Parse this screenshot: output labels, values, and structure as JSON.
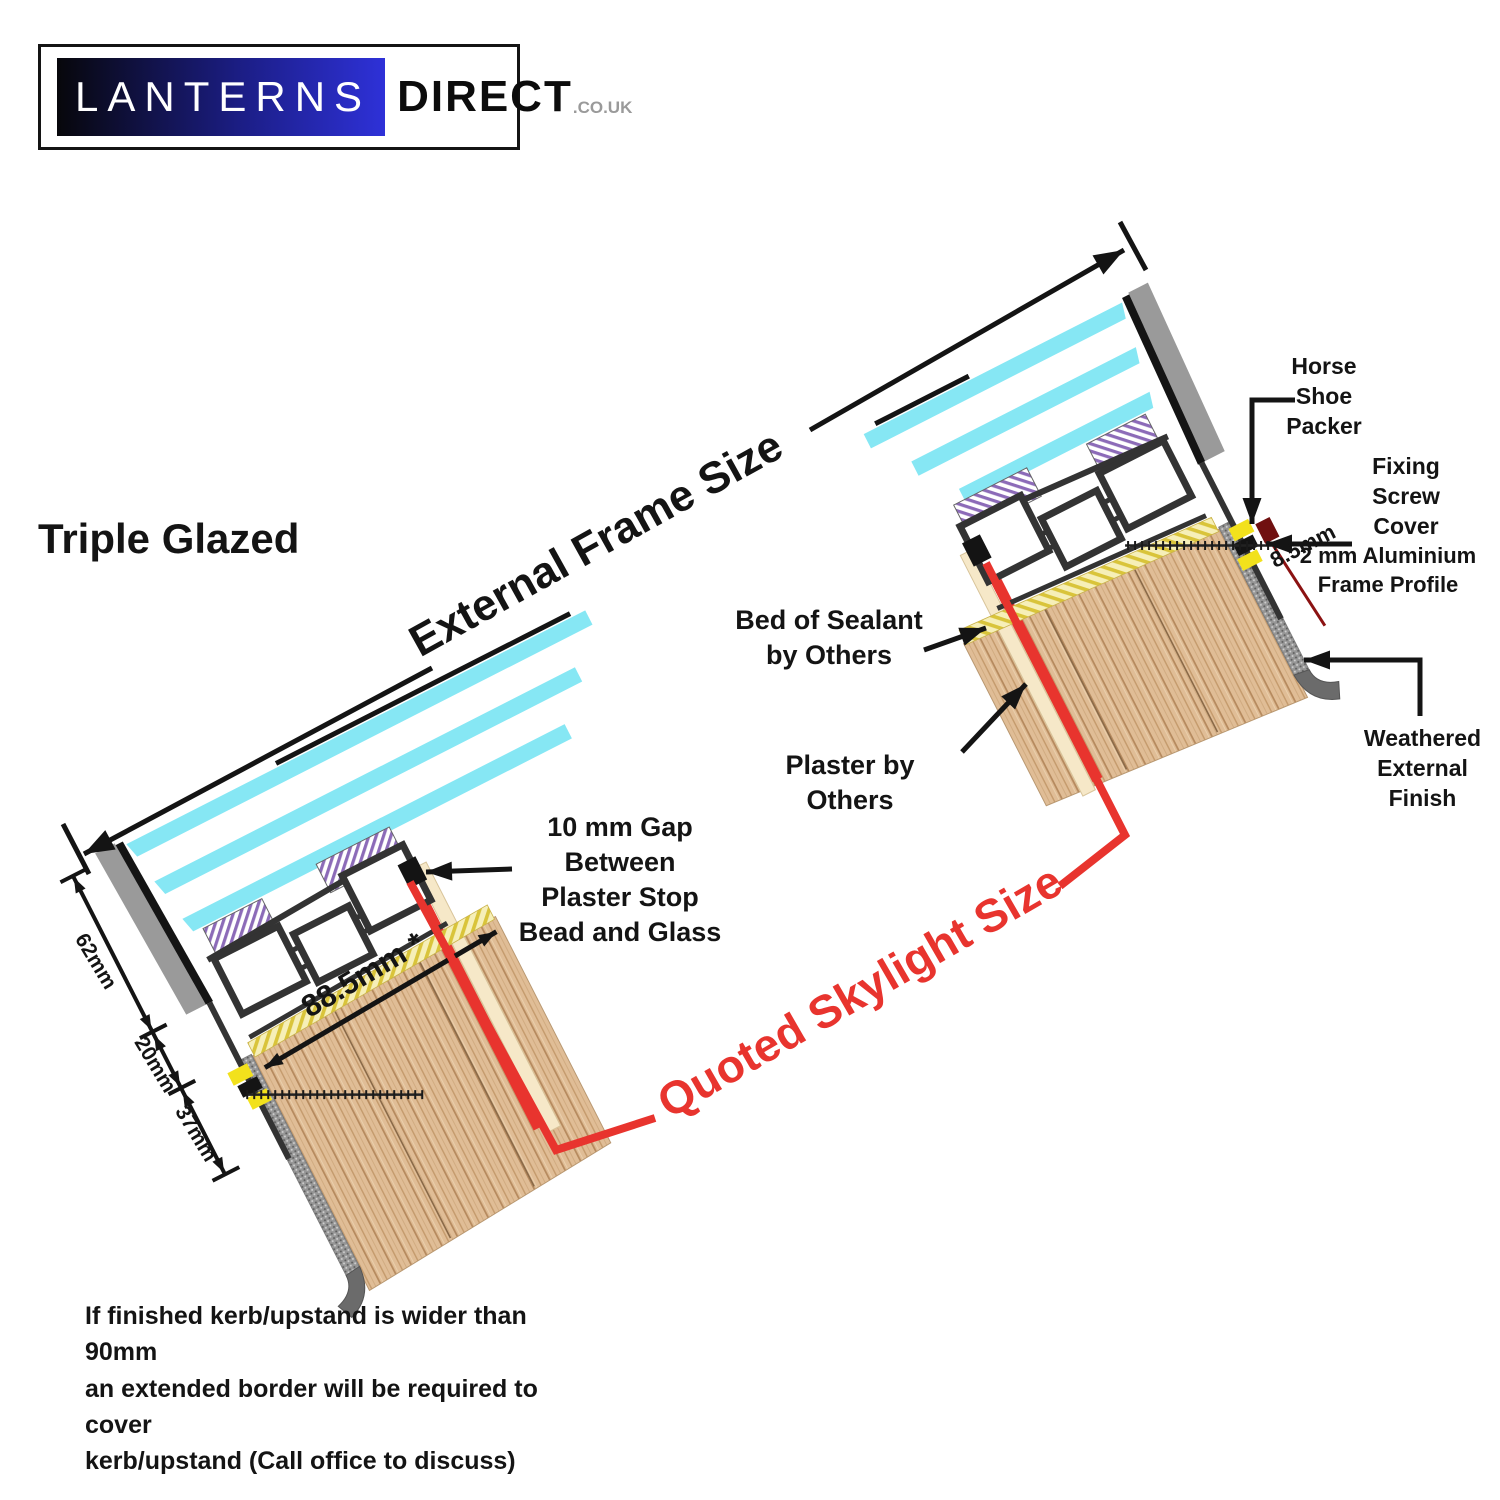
{
  "logo": {
    "brand_primary": "LANTERNS",
    "brand_secondary": "DIRECT",
    "brand_tld": ".CO.UK"
  },
  "title": "Triple Glazed",
  "dimension_labels": {
    "external_frame": "External Frame Size",
    "quoted_skylight": "Quoted Skylight Size",
    "glass_zone": "62mm",
    "frame_zone": "20mm",
    "packer_zone": "37mm",
    "frame_width": "88.5mm *",
    "profile_thickness": "8.5mm"
  },
  "annotations": {
    "horse_shoe_packer": "Horse\nShoe\nPacker",
    "fixing_screw_cover": "Fixing\nScrew\nCover",
    "aluminium_profile": "2 mm Aluminium\nFrame Profile",
    "bed_of_sealant": "Bed of Sealant\nby Others",
    "plaster": "Plaster by Others",
    "weathered_finish": "Weathered\nExternal\nFinish",
    "plaster_gap": "10 mm Gap\nBetween\nPlaster Stop\nBead and Glass"
  },
  "footnote": "If finished kerb/upstand is wider than 90mm\nan extended border will be required to cover\nkerb/upstand (Call office to discuss)",
  "colors": {
    "glass": "#86e7f4",
    "frame": "#333333",
    "chamber_fill": "#ffffff",
    "gasket": "#8c6bb8",
    "sealant_base": "#f6efb8",
    "sealant_stripe": "#d9c43a",
    "wood": "#e0bd96",
    "wood_grain": "#c49a6c",
    "plaster": "#f6e8c8",
    "quoted_red": "#e8342e",
    "cap_gray": "#9a9a9a",
    "weathered": "#969696",
    "packer_yellow": "#f2e11c",
    "screw_cover": "#701010",
    "ink": "#141414"
  }
}
